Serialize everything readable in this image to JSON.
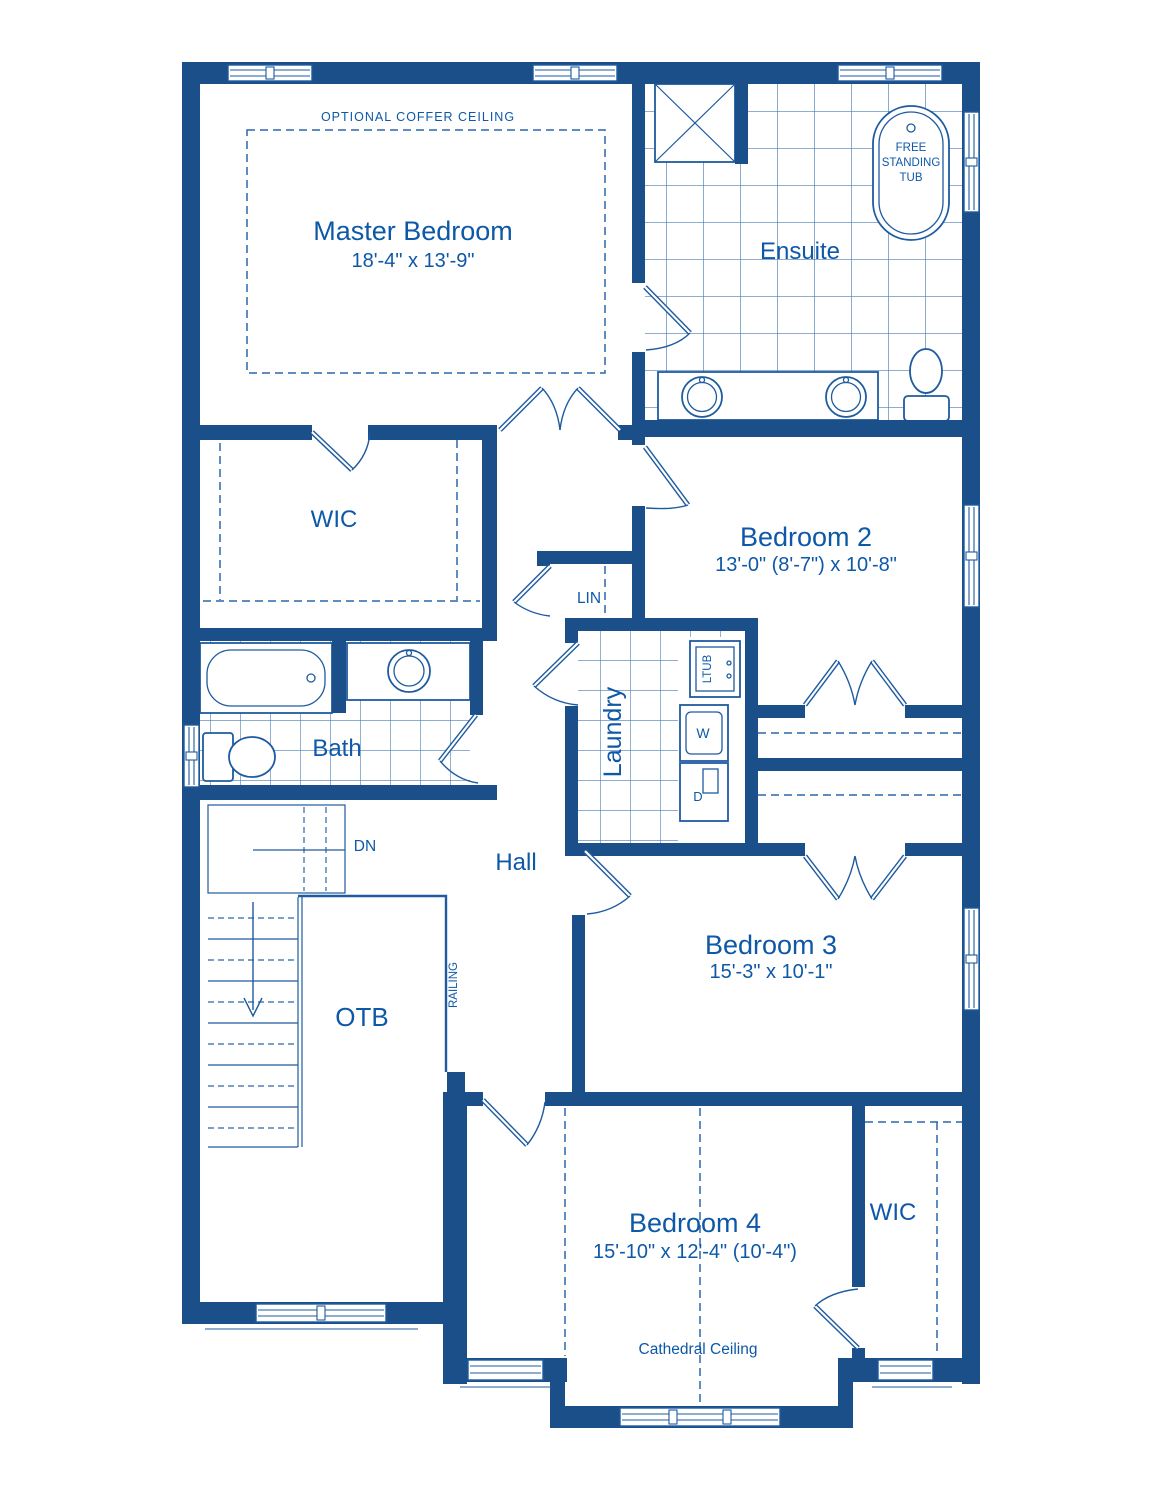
{
  "plan": {
    "colors": {
      "wall": "#1a4f8a",
      "fixture_line": "#1e5b9f",
      "text": "#0e58a8",
      "tile_line": "#4a7cb5",
      "background": "#ffffff"
    },
    "master_bedroom": {
      "label": "Master Bedroom",
      "dimensions": "18'-4\" x 13'-9\"",
      "ceiling_note": "OPTIONAL COFFER CEILING"
    },
    "ensuite": {
      "label": "Ensuite",
      "tub_note_lines": [
        "FREE",
        "STANDING",
        "TUB"
      ]
    },
    "wic_master": {
      "label": "WIC"
    },
    "bath": {
      "label": "Bath"
    },
    "linen": {
      "label": "LIN"
    },
    "laundry": {
      "label": "Laundry",
      "laundry_tub": "LTUB",
      "washer": "W",
      "dryer": "D"
    },
    "bedroom2": {
      "label": "Bedroom 2",
      "dimensions": "13'-0\" (8'-7\") x 10'-8\""
    },
    "bedroom3": {
      "label": "Bedroom 3",
      "dimensions": "15'-3\" x 10'-1\""
    },
    "bedroom4": {
      "label": "Bedroom 4",
      "dimensions": "15'-10\" x 12'-4\" (10'-4\")",
      "ceiling_note": "Cathedral Ceiling"
    },
    "wic_bedroom4": {
      "label": "WIC"
    },
    "hall": {
      "label": "Hall"
    },
    "stairs": {
      "label": "DN"
    },
    "open_to_below": {
      "label": "OTB",
      "railing_label": "RAILING"
    }
  }
}
